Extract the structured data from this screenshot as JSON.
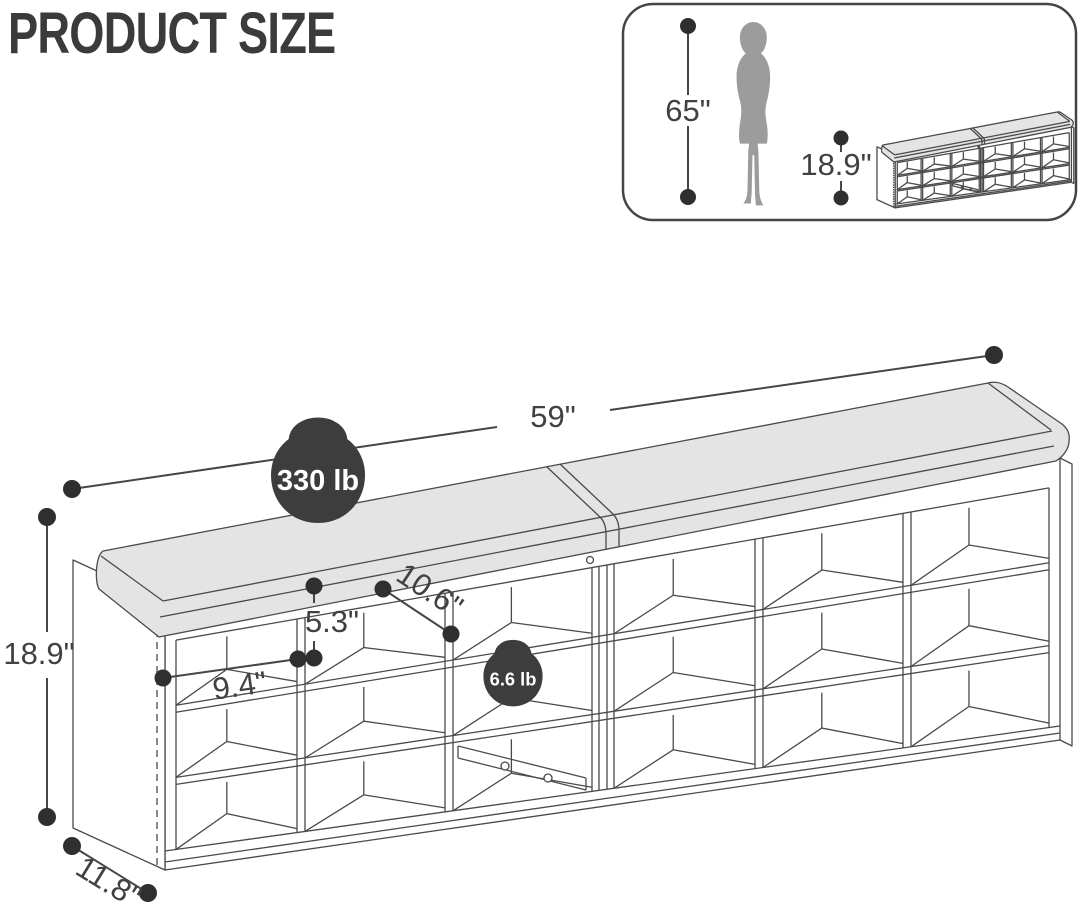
{
  "title": "PRODUCT SIZE",
  "colors": {
    "line": "#4a4a4a",
    "dim_line": "#464646",
    "label_text": "#414141",
    "cushion_fill": "#e4e4e4",
    "kettlebell_fill": "#3d3d3d",
    "silhouette_fill": "#9c9c9c",
    "title_text": "#3b3b3b"
  },
  "reference_box": {
    "person_height_label": "65\"",
    "bench_height_label": "18.9\""
  },
  "main_diagram": {
    "width_label": "59\"",
    "height_label": "18.9\"",
    "depth_label": "11.8\"",
    "cubby_height_label": "5.3\"",
    "cubby_depth_label": "10.6\"",
    "cubby_width_label": "9.4\"",
    "max_load_label": "330 lb",
    "shelf_load_label": "6.6 lb"
  }
}
